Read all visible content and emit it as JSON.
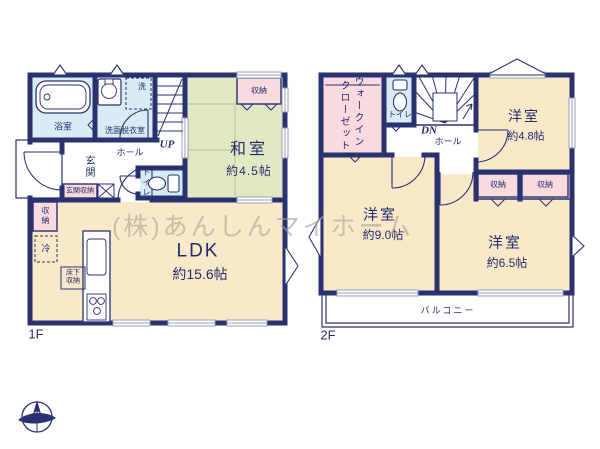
{
  "watermark": "(株)あんしんマイホーム",
  "colors": {
    "wall": "#2a3170",
    "room_cream": "#f9e9c9",
    "room_green": "#e0e9c4",
    "room_pink": "#f9dade",
    "room_blue": "#d8ecf6",
    "window_gray": "#97a0ba",
    "text": "#232c6b"
  },
  "floor1": {
    "label": "1F",
    "bathroom": "浴室",
    "washroom": "洗面脱衣室",
    "laundry": "洗",
    "stairs": "UP",
    "entrance": "玄関",
    "entrance_storage": "玄関収納",
    "hall": "ホール",
    "toilet": "トイレ",
    "washitsu": "和室",
    "washitsu_size": "約4.5帖",
    "washitsu_storage": "収納",
    "ldk": "LDK",
    "ldk_size": "約15.6帖",
    "ldk_storage": "収納",
    "fridge": "冷",
    "underfloor_storage": "床下収納"
  },
  "floor2": {
    "label": "2F",
    "wic_line1": "ウォークイン",
    "wic_line2": "クローゼット",
    "toilet": "トイレ",
    "stairs": "DN",
    "hall": "ホール",
    "room_48": "洋室",
    "room_48_size": "約4.8帖",
    "storage_a": "収納",
    "storage_b": "収納",
    "room_90": "洋室",
    "room_90_size": "約9.0帖",
    "room_65": "洋室",
    "room_65_size": "約6.5帖",
    "balcony": "バルコニー"
  }
}
